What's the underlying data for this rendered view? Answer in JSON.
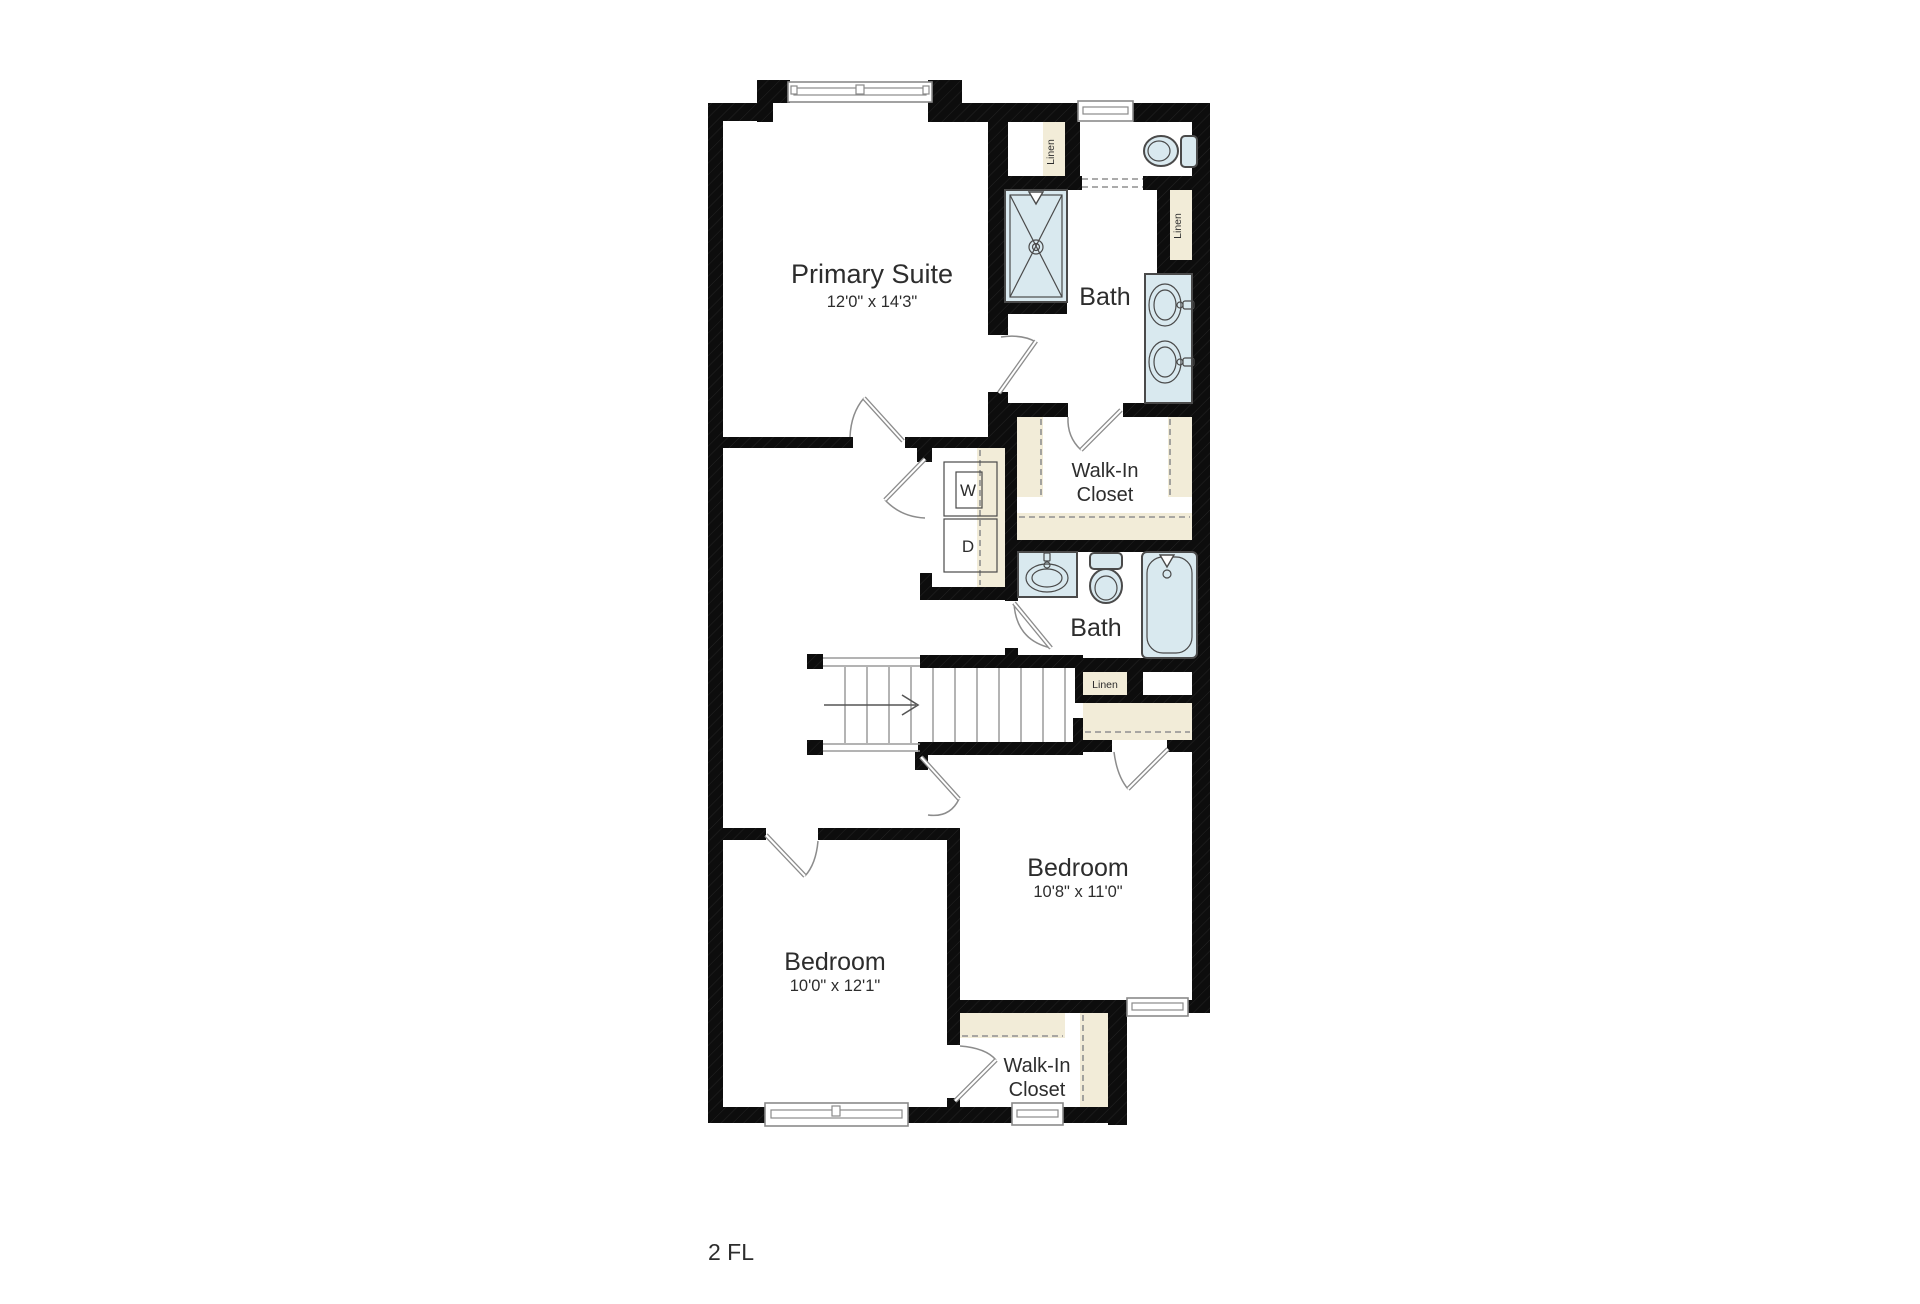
{
  "floor_label": "2 FL",
  "rooms": {
    "primary_suite": {
      "name": "Primary Suite",
      "dims": "12'0\" x 14'3\""
    },
    "bath_top": {
      "name": "Bath"
    },
    "bath_mid": {
      "name": "Bath"
    },
    "walk_in_closet_top": {
      "line1": "Walk-In",
      "line2": "Closet"
    },
    "walk_in_closet_bottom": {
      "line1": "Walk-In",
      "line2": "Closet"
    },
    "bedroom_right": {
      "name": "Bedroom",
      "dims": "10'8\" x 11'0\""
    },
    "bedroom_left": {
      "name": "Bedroom",
      "dims": "10'0\" x 12'1\""
    }
  },
  "closets": {
    "linen_top_left": "Linen",
    "linen_bath_right": "Linen",
    "linen_hall": "Linen"
  },
  "appliances": {
    "washer": "W",
    "dryer": "D"
  },
  "colors": {
    "wall": "#0d0d0d",
    "fixture_fill": "#d9e9ef",
    "fixture_stroke": "#4a4a4a",
    "shelf_fill": "#f2ecd8",
    "door_line": "#8c8c8c",
    "window_line": "#8a8a8a",
    "stair_line": "#9a9a9a",
    "text": "#2d2d2d",
    "dash_line": "#8f8f8f",
    "bg": "#ffffff"
  }
}
